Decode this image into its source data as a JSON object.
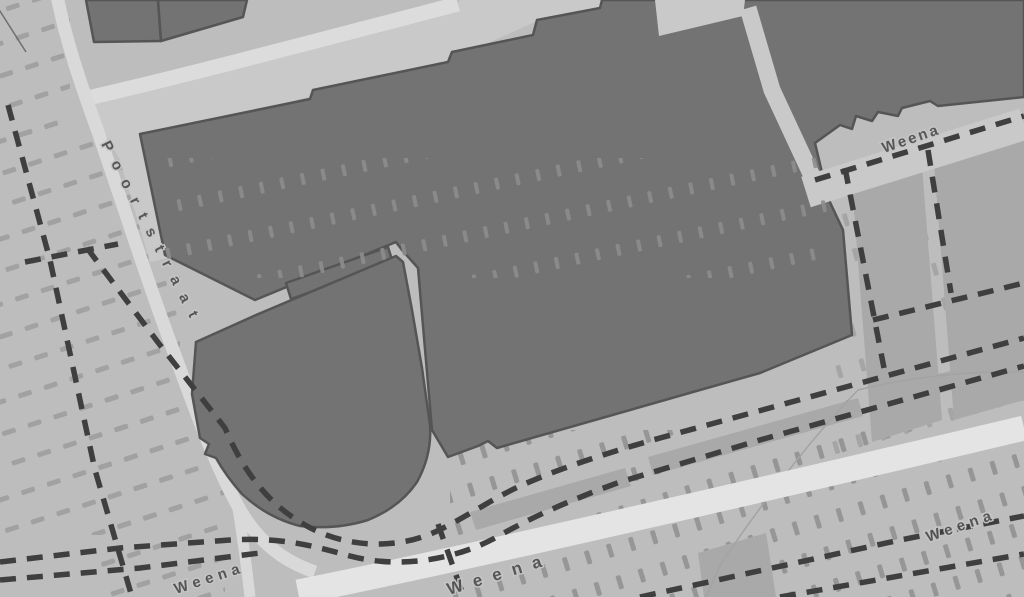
{
  "map": {
    "kind": "grayscale-street-map",
    "street_labels": {
      "poortstraat": "Poortstraat",
      "weena_top_right": "Weena",
      "weena_bottom_left": "Weena",
      "weena_bottom_center": "Weena",
      "weena_bottom_right": "Weena"
    },
    "colors": {
      "background": "#bdbdbd",
      "plaza": "#c9c9c9",
      "road_major": "#e4e4e4",
      "road_minor": "#d9d9d9",
      "building_fill": "#737373",
      "building_outline": "#555555",
      "parcel": "#a9a9a9",
      "tunnel_dash": "#3f3f3f",
      "hatch_on_background": "#9d9d9d",
      "hatch_on_building": "#8d8d8d",
      "label_text": "#515151",
      "label_halo": "#c6c6c6"
    }
  }
}
